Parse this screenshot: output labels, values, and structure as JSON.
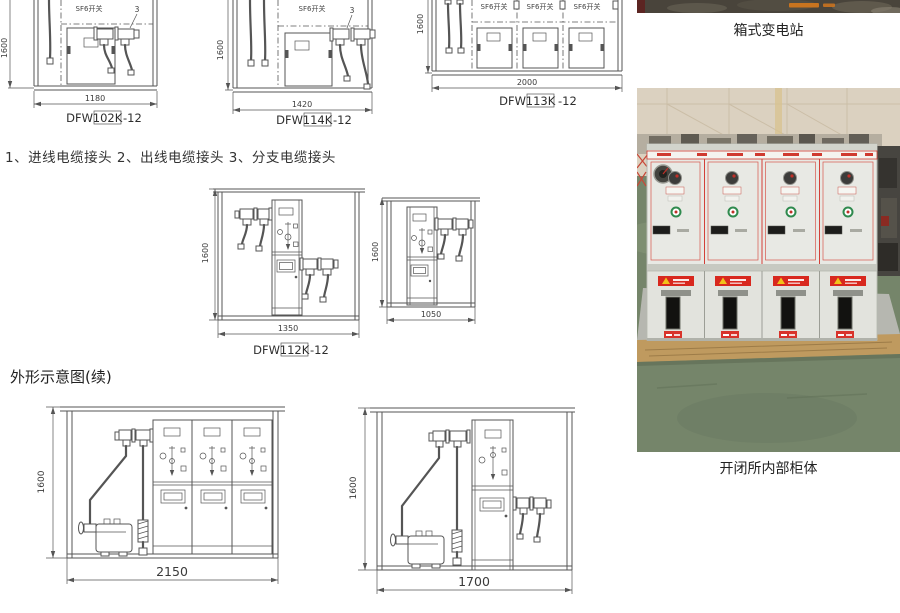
{
  "note_line": "1、进线电缆接头   2、出线电缆接头   3、分支电缆接头",
  "section_title": "外形示意图(续)",
  "captions": {
    "top_photo": "箱式变电站",
    "main_photo": "开闭所内部柜体"
  },
  "drawings": {
    "d102k": {
      "sf6": "SF6开关",
      "pointer": "3",
      "dim_h": "1600",
      "dim_w": "1180",
      "model_prefix": "DFW",
      "model_boxed": "102K",
      "model_suffix": "-12"
    },
    "d114k": {
      "sf6": "SF6开关",
      "pointer": "3",
      "dim_h": "1600",
      "dim_w": "1420",
      "model_prefix": "DFW",
      "model_boxed": "114K",
      "model_suffix": "-12"
    },
    "d113k": {
      "sf6_1": "SF6开关",
      "sf6_2": "SF6开关",
      "sf6_3": "SF6开关",
      "dim_h": "1600",
      "dim_w": "2000",
      "model_prefix": "DFW",
      "model_boxed": "113K",
      "model_suffix": "-12"
    },
    "d112k": {
      "dim_h": "1600",
      "dim_w": "1350",
      "model_prefix": "DFW",
      "model_boxed": "112K",
      "model_suffix": "-12"
    },
    "d1050": {
      "dim_h": "1600",
      "dim_w": "1050"
    },
    "d2150": {
      "dim_h": "1600",
      "dim_w": "2150"
    },
    "d1700": {
      "dim_h": "1600",
      "dim_w": "1700"
    }
  },
  "colors": {
    "line": "#555555",
    "accent_red": "#cf3a30",
    "wall_beige": "#dbd1c0",
    "floor_green": "#75856a",
    "panel_gray": "#e8e9e4",
    "pallet_wood": "#bf9a5f",
    "concrete": "#b6b7b0",
    "photo_maroon": "#5c2522",
    "watermark_orange": "#d0761e"
  }
}
